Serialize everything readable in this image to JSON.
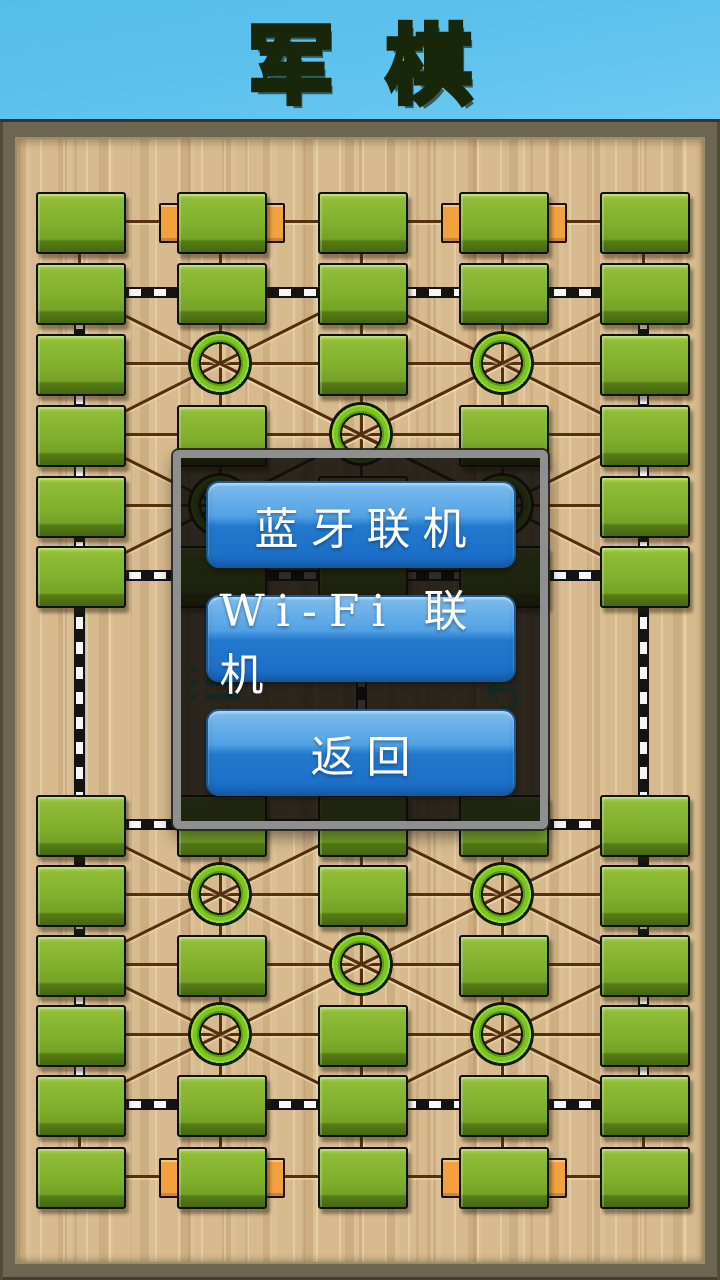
{
  "title": {
    "text": "军棋"
  },
  "dialog": {
    "buttons": [
      {
        "id": "bluetooth",
        "label": "蓝牙联机"
      },
      {
        "id": "wifi",
        "label": "Wi-Fi 联机"
      },
      {
        "id": "back",
        "label": "返回"
      }
    ]
  },
  "icons": [
    {
      "name": "menu-icon",
      "meaning": "in-game menu list button"
    },
    {
      "name": "undo-icon",
      "meaning": "undo / take back move button"
    }
  ],
  "board": {
    "columns_x": [
      79,
      220,
      361,
      502,
      643
    ],
    "rows_y": [
      221,
      292,
      363,
      434,
      505,
      575,
      824,
      894,
      964,
      1034,
      1104,
      1176
    ],
    "pieces_by_row": [
      [
        0,
        1,
        2,
        3,
        4
      ],
      [
        0,
        1,
        2,
        3,
        4
      ],
      [
        0,
        2,
        4
      ],
      [
        0,
        1,
        3,
        4
      ],
      [
        0,
        2,
        4
      ],
      [
        0,
        1,
        2,
        3,
        4
      ],
      [
        0,
        1,
        2,
        3,
        4
      ],
      [
        0,
        2,
        4
      ],
      [
        0,
        1,
        3,
        4
      ],
      [
        0,
        2,
        4
      ],
      [
        0,
        1,
        2,
        3,
        4
      ],
      [
        0,
        1,
        2,
        3,
        4
      ]
    ],
    "camps": [
      [
        2,
        1
      ],
      [
        2,
        3
      ],
      [
        3,
        2
      ],
      [
        4,
        1
      ],
      [
        4,
        3
      ],
      [
        7,
        1
      ],
      [
        7,
        3
      ],
      [
        8,
        2
      ],
      [
        9,
        1
      ],
      [
        9,
        3
      ]
    ],
    "headquarters": [
      [
        0,
        1
      ],
      [
        0,
        3
      ],
      [
        11,
        1
      ],
      [
        11,
        3
      ]
    ],
    "rail_rows": [
      1,
      5,
      6,
      10
    ],
    "rail_cols_full": [
      0,
      4
    ],
    "rail_col_center": {
      "col": 2,
      "from_row": 5,
      "to_row": 6
    },
    "plain_line_rows": [
      0,
      2,
      3,
      4,
      7,
      8,
      9,
      11
    ],
    "plain_vcols_inner": [
      1,
      2,
      3
    ],
    "halves": [
      [
        0,
        5
      ],
      [
        6,
        11
      ]
    ],
    "colors": {
      "sky_blue": "#5ec3ee",
      "title_green": "#84ad2c",
      "wood_tan": "#d7bb8f",
      "frame_brown": "#6e6550",
      "piece_green": "#80b02c",
      "camp_green": "#7cc41f",
      "hq_orange": "#f2a13e",
      "rail_black": "#131313",
      "rail_white": "#f6f6f6",
      "line_brown": "#56300f",
      "button_blue": "#2379cd",
      "dialog_border_grey": "#8f8f8f",
      "icon_teal": "#3ed2c4"
    }
  }
}
